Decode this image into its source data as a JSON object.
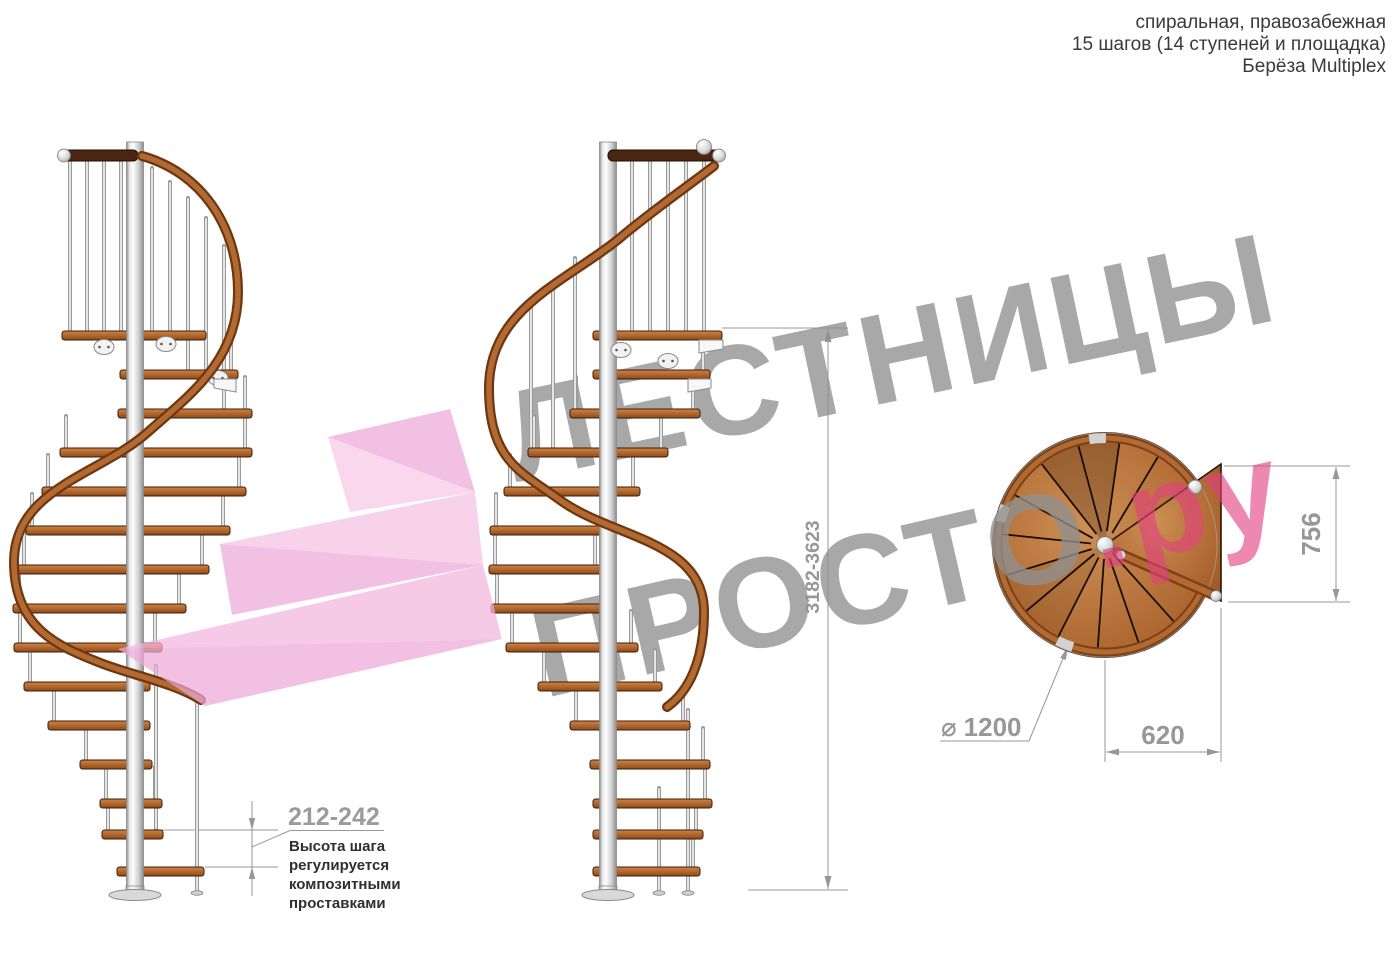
{
  "header": {
    "line1": "спиральная, правозабежная",
    "line2": "15 шагов (14 ступеней и площадка)",
    "line3": "Берёза Multiplex"
  },
  "watermark": {
    "line1": "ЛЕСТНИЦЫ",
    "line2_gray": "ПРОСТО",
    "line2_pink": ".ру"
  },
  "dimensions": {
    "total_height": "3182-3623",
    "step_height": "212-242",
    "platform_depth": "756",
    "platform_width": "620",
    "diameter_symbol": "⌀",
    "diameter_value": "1200"
  },
  "step_note": {
    "line1": "Высота шага",
    "line2": "регулируется",
    "line3": "композитными",
    "line4": "проставками"
  },
  "colors": {
    "wood_mid": "#b06428",
    "wood_light": "#cd8448",
    "wood_dark": "#6f3611",
    "rail_dark": "#4a2610",
    "metal_light": "#f0f0f0",
    "metal_mid": "#c9c9c9",
    "metal_dark": "#8f8f8f",
    "dim_gray": "#979797",
    "note_text": "#2f2f2f",
    "watermark_gray": "#8f8f8f",
    "watermark_pink": "#e2417f",
    "logo_pink_light": "#f6c8e6",
    "logo_pink_deep": "#eda8d8"
  }
}
